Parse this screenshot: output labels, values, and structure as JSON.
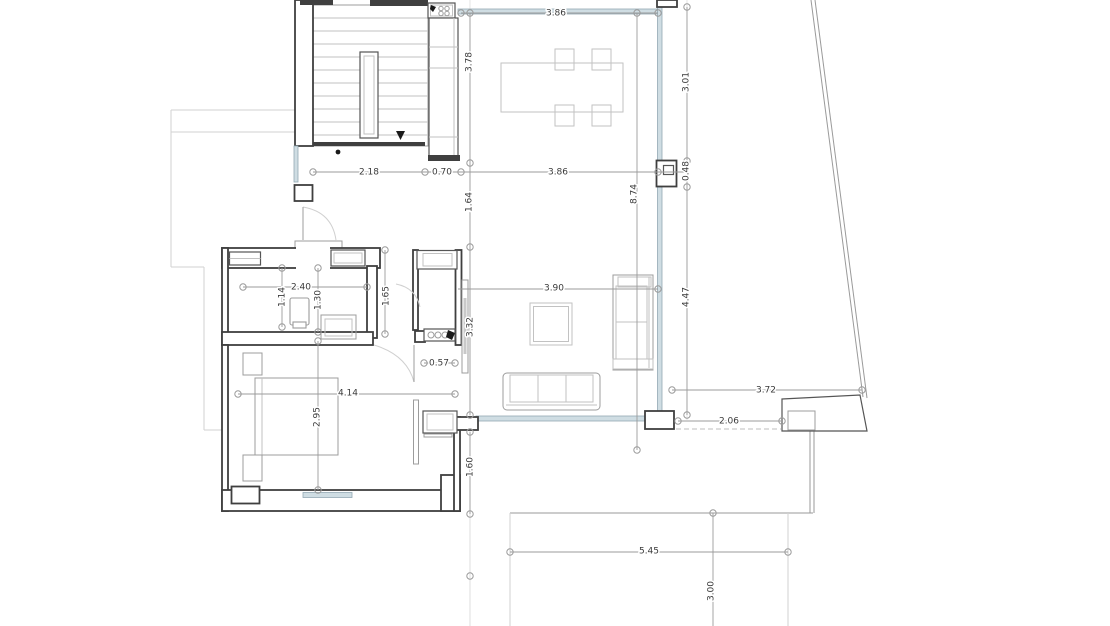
{
  "drawing": {
    "type": "architectural-floor-plan",
    "units": "m",
    "line_colors": {
      "walls": "#3f3f3f",
      "furniture": "#9c9c9c",
      "glazing": "#cfdde3",
      "dimensions": "#9b9b9b"
    }
  },
  "dims": {
    "dining_top_width": "3.86",
    "stair_width": "2.18",
    "counter_depth": "0.70",
    "dining_width": "3.86",
    "kitchen_counter_length": "3.78",
    "entry_gap": "1.64",
    "great_room_length": "8.74",
    "glass_segment_upper": "3.01",
    "column_width": "0.48",
    "glass_segment_lower": "4.47",
    "living_width": "3.90",
    "bath_width": "2.40",
    "bath_depth_a": "1.14",
    "bath_depth_b": "1.30",
    "hall_width": "1.65",
    "tv_wall_length": "3.32",
    "nook_width": "0.57",
    "bedroom_width": "4.14",
    "bedroom_depth": "2.95",
    "rear_offset": "1.60",
    "patio_offset_a": "3.72",
    "patio_offset_b": "2.06",
    "terrace_width": "5.45",
    "terrace_depth": "3.00"
  }
}
